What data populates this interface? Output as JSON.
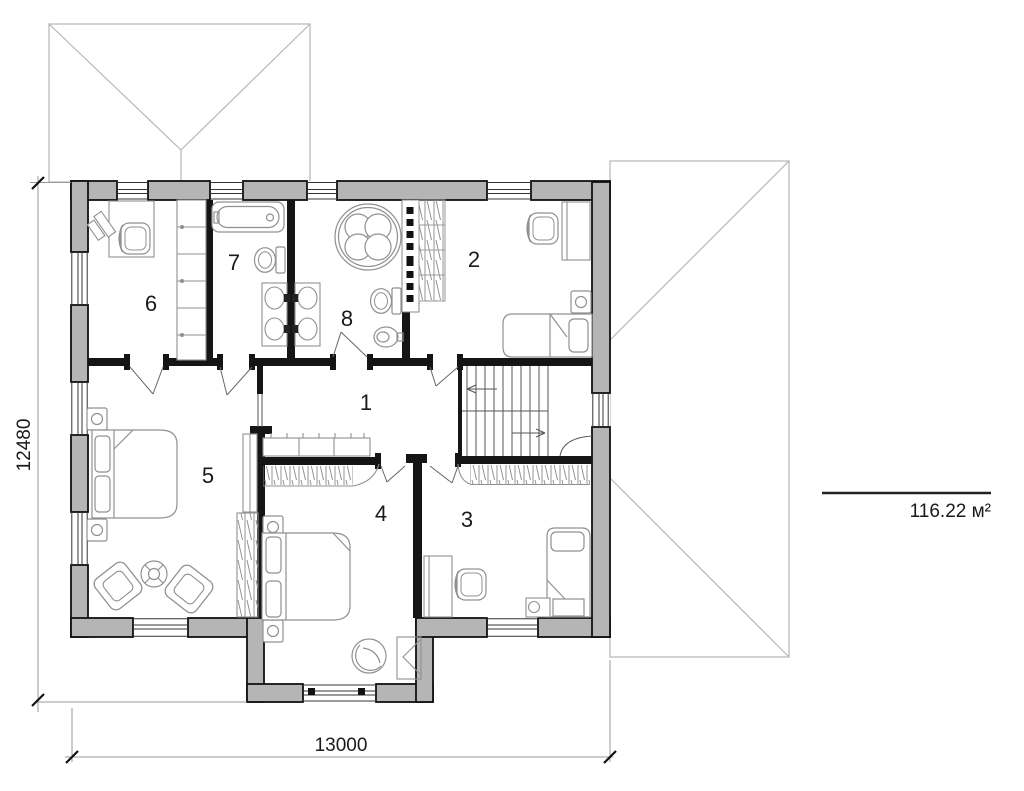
{
  "plan": {
    "rooms": [
      {
        "number": "1"
      },
      {
        "number": "2"
      },
      {
        "number": "3"
      },
      {
        "number": "4"
      },
      {
        "number": "5"
      },
      {
        "number": "6"
      },
      {
        "number": "7"
      },
      {
        "number": "8"
      }
    ],
    "dimensions": {
      "bottom": "13000",
      "left": "12480"
    },
    "area_label": "116.22 м²",
    "colors": {
      "wall_fill": "#b5b5b5",
      "wall_outline": "#111111",
      "interior_wall": "#151515",
      "roof_line": "#b3b6b9",
      "fixture_line": "#909090"
    }
  }
}
